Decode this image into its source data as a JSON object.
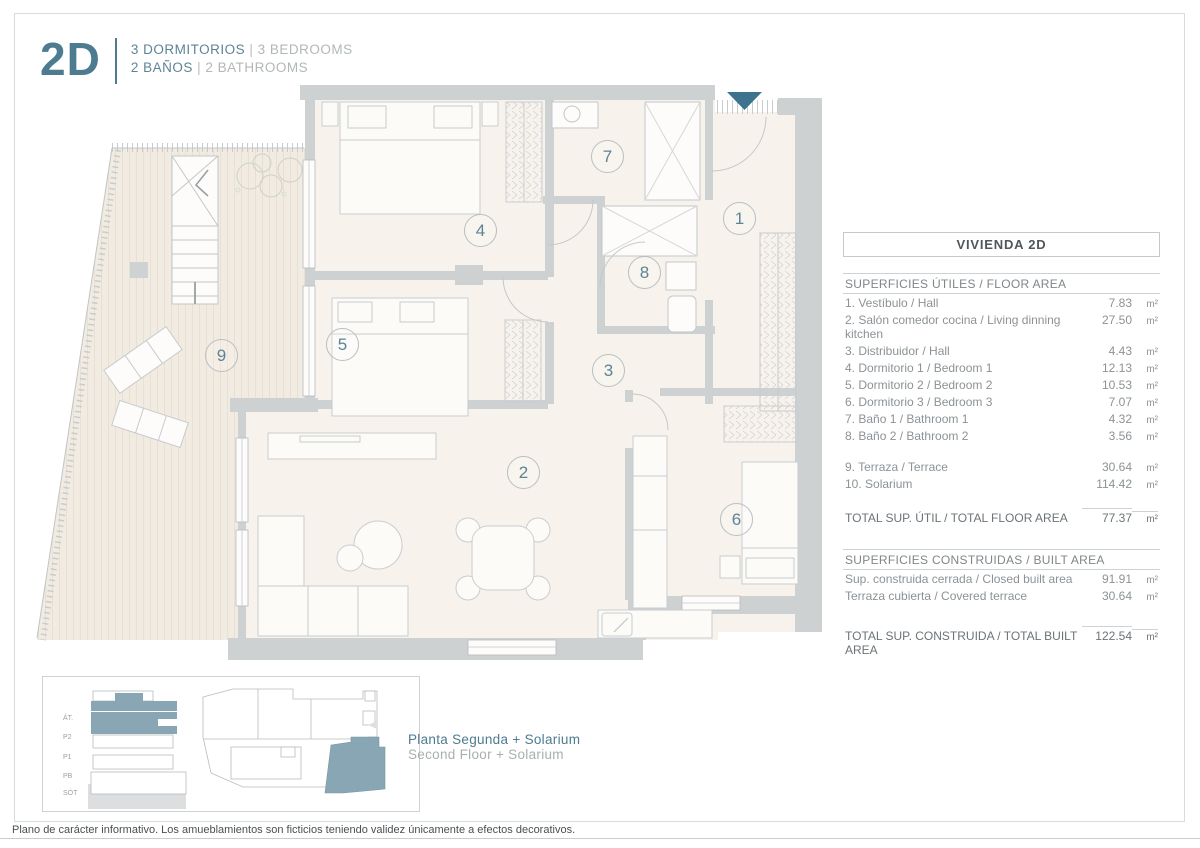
{
  "header": {
    "unit": "2D",
    "line1_es": "3 DORMITORIOS",
    "line1_en": "3 BEDROOMS",
    "line2_es": "2 BAÑOS",
    "line2_en": "2 BATHROOMS",
    "pipe": "|"
  },
  "panel": {
    "title": "VIVIENDA 2D",
    "floor": {
      "header": "SUPERFICIES ÚTILES / FLOOR AREA",
      "rows": [
        {
          "label": "1. Vestíbulo / Hall",
          "value": "7.83",
          "unit": "m²"
        },
        {
          "label": "2. Salón comedor cocina / Living dinning kitchen",
          "value": "27.50",
          "unit": "m²"
        },
        {
          "label": "3. Distribuidor / Hall",
          "value": "4.43",
          "unit": "m²"
        },
        {
          "label": "4. Dormitorio 1 / Bedroom 1",
          "value": "12.13",
          "unit": "m²"
        },
        {
          "label": "5. Dormitorio 2 / Bedroom 2",
          "value": "10.53",
          "unit": "m²"
        },
        {
          "label": "6. Dormitorio 3 / Bedroom 3",
          "value": "7.07",
          "unit": "m²"
        },
        {
          "label": "7. Baño 1 / Bathroom 1",
          "value": "4.32",
          "unit": "m²"
        },
        {
          "label": "8. Baño 2 / Bathroom 2",
          "value": "3.56",
          "unit": "m²"
        }
      ],
      "outdoor_rows": [
        {
          "label": "9. Terraza / Terrace",
          "value": "30.64",
          "unit": "m²"
        },
        {
          "label": "10. Solarium",
          "value": "114.42",
          "unit": "m²"
        }
      ],
      "total": {
        "label": "TOTAL SUP. ÚTIL / TOTAL FLOOR AREA",
        "value": "77.37",
        "unit": "m²"
      }
    },
    "built": {
      "header": "SUPERFICIES CONSTRUIDAS / BUILT AREA",
      "rows": [
        {
          "label": "Sup. construida cerrada / Closed built area",
          "value": "91.91",
          "unit": "m²"
        },
        {
          "label": "Terraza cubierta / Covered terrace",
          "value": "30.64",
          "unit": "m²"
        }
      ],
      "total": {
        "label": "TOTAL SUP. CONSTRUIDA /  TOTAL BUILT AREA",
        "value": "122.54",
        "unit": "m²"
      }
    }
  },
  "plan": {
    "room_markers": [
      {
        "n": "1"
      },
      {
        "n": "2"
      },
      {
        "n": "3"
      },
      {
        "n": "4"
      },
      {
        "n": "5"
      },
      {
        "n": "6"
      },
      {
        "n": "7"
      },
      {
        "n": "8"
      },
      {
        "n": "9"
      }
    ]
  },
  "keyplan": {
    "levels": [
      "ÁT.",
      "P2",
      "P1",
      "PB",
      "SÓT"
    ],
    "caption_es": "Planta Segunda + Solarium",
    "caption_en": "Second Floor + Solarium"
  },
  "footer": {
    "disclaimer": "Plano de carácter informativo. Los amueblamientos son ficticios teniendo validez únicamente a efectos decorativos."
  },
  "colors": {
    "accent": "#4d7b8f",
    "entrance_arrow": "#3e7390",
    "keyplan_highlight": "#88a6b3",
    "wall": "#cdd1d2",
    "floor": "#f7f2ec",
    "terrace": "#f2ebe1"
  }
}
